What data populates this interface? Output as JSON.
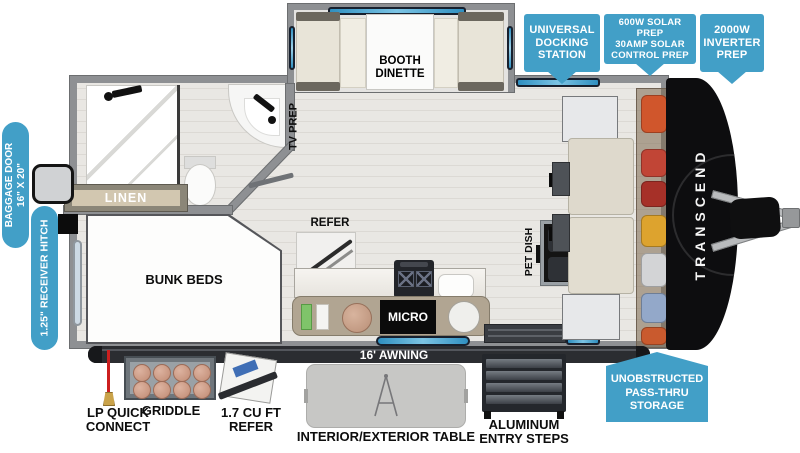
{
  "callouts": {
    "docking": "UNIVERSAL\nDOCKING\nSTATION",
    "solar": "600W SOLAR PREP\n30AMP SOLAR\nCONTROL PREP",
    "inverter": "2000W\nINVERTER\nPREP",
    "passthru": "UNOBSTRUCTED\nPASS-THRU\nSTORAGE",
    "baggage_door": "BAGGAGE DOOR\n16\" X 20\"",
    "receiver_hitch": "1.25\" RECEIVER HITCH"
  },
  "floorplan": {
    "booth_dinette": "BOOTH\nDINETTE",
    "tv_prep": "TV PREP",
    "linen": "LINEN",
    "bunk_beds": "BUNK BEDS",
    "refer": "REFER",
    "pet_dish": "PET DISH",
    "micro": "MICRO",
    "awning": "16' AWNING",
    "brand": "TRANSCEND"
  },
  "exterior_features": {
    "lp_quick_connect": "LP QUICK\nCONNECT",
    "griddle": "GRIDDLE",
    "mini_refer": "1.7 CU FT\nREFER",
    "table": "INTERIOR/EXTERIOR TABLE",
    "steps": "ALUMINUM\nENTRY STEPS"
  },
  "colors": {
    "callout_blue": "#429FC7",
    "wall_gray": "#8E9093",
    "awning_dark": "#2B2D31",
    "window_blue": "#2F8FC0",
    "front_cap_black": "#0D0D0F"
  },
  "storage": {
    "gear": [
      "#D0562C",
      "#C14536",
      "#A63028",
      "#DDA32E",
      "#D3D4D6",
      "#93A8C9",
      "#C95A2E"
    ]
  }
}
